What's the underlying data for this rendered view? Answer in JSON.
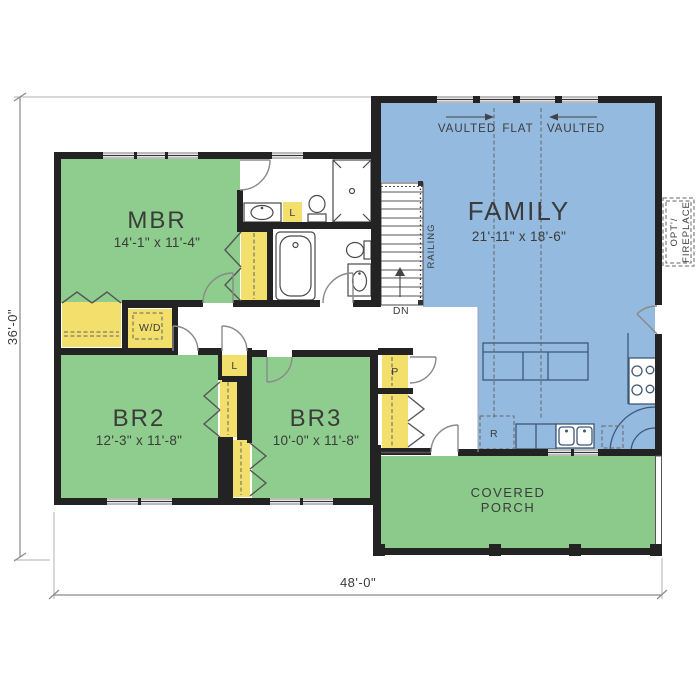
{
  "rooms": {
    "mbr": {
      "name": "MBR",
      "dims": "14'-1\" x 11'-4\""
    },
    "br2": {
      "name": "BR2",
      "dims": "12'-3\" x 11'-8\""
    },
    "br3": {
      "name": "BR3",
      "dims": "10'-0\" x 11'-8\""
    },
    "family": {
      "name": "FAMILY",
      "dims": "21'-11\" x 18'-6\""
    },
    "porch": {
      "name_line1": "COVERED",
      "name_line2": "PORCH"
    }
  },
  "ceiling_labels": {
    "vaulted_left": "VAULTED",
    "flat": "FLAT",
    "vaulted_right": "VAULTED"
  },
  "stair_labels": {
    "railing": "RAILING",
    "down": "DN"
  },
  "fixture_labels": {
    "washer_dryer": "W/D",
    "linen_bath": "L",
    "linen_hall": "L",
    "pantry": "P",
    "refrigerator": "R"
  },
  "fireplace": {
    "line1": "OPT'/",
    "line2": "FIREPLACE"
  },
  "dimensions": {
    "overall_width": "48'-0\"",
    "overall_height": "36'-0\""
  },
  "colors": {
    "bedroom_green": "#8ECD8D",
    "porch_green": "#8CCA8B",
    "family_blue": "#94BADF",
    "closet_yellow": "#F3DF6C",
    "wall": "#232323"
  }
}
